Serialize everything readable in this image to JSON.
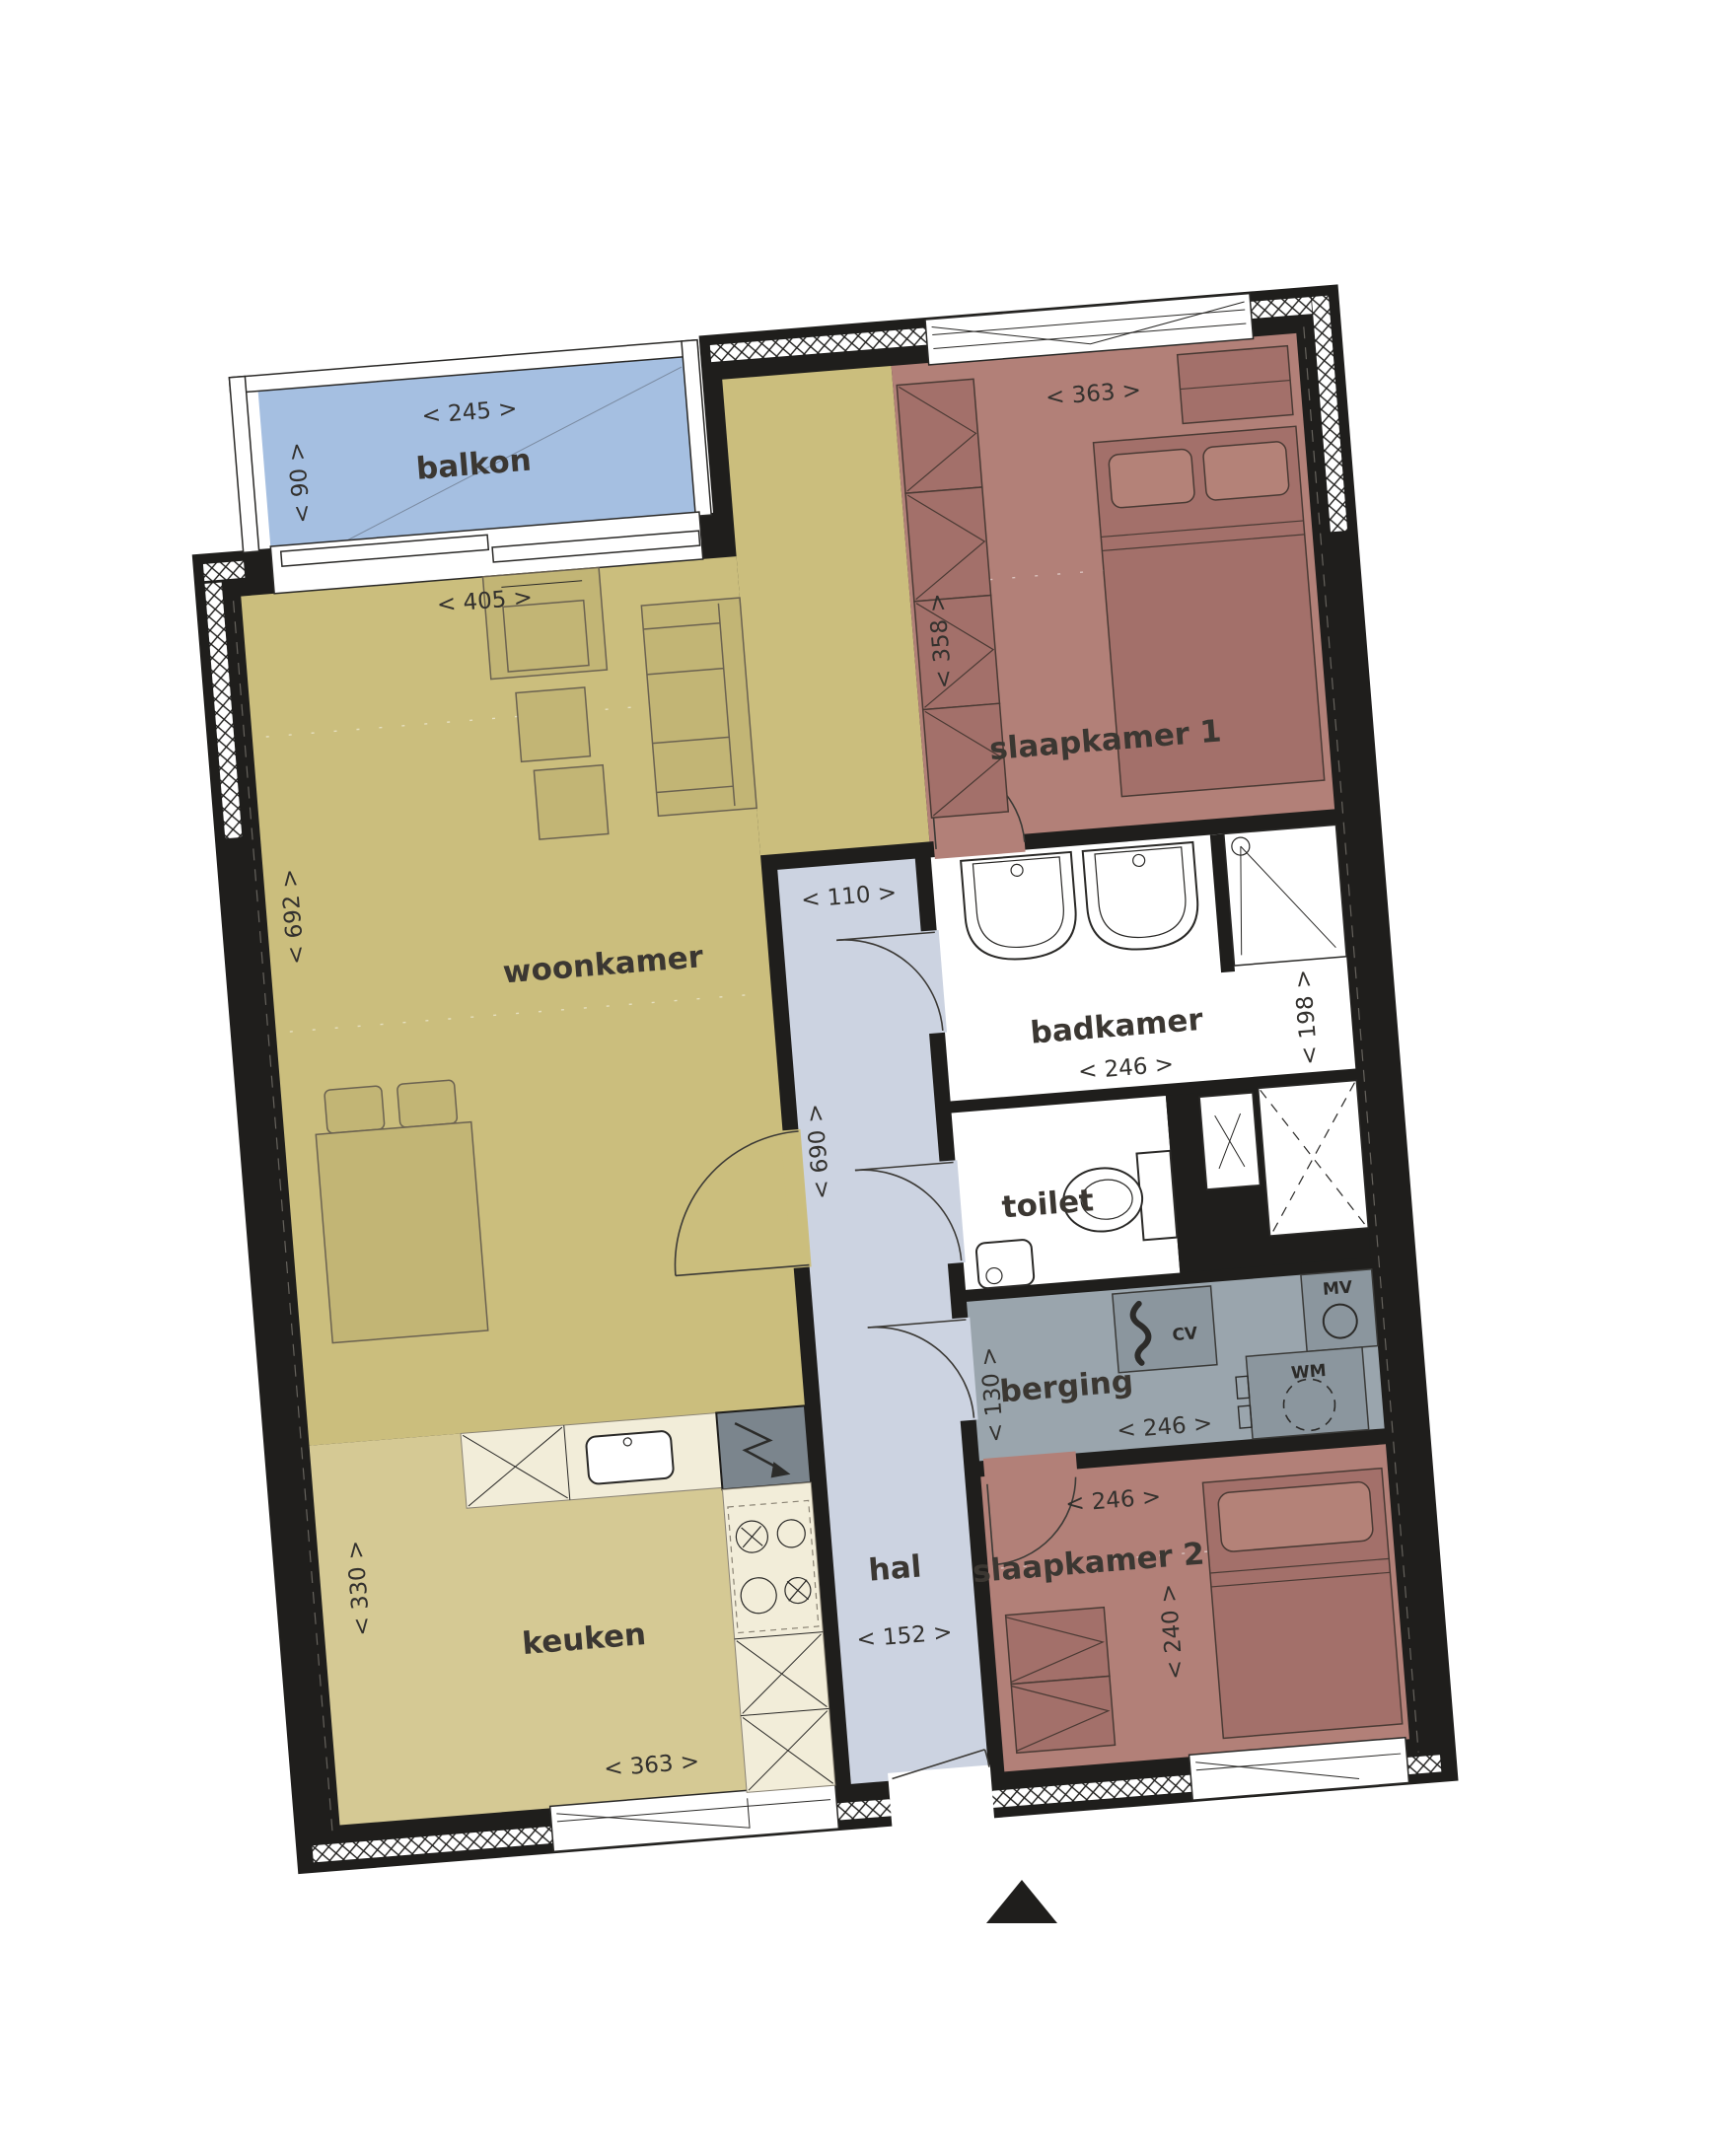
{
  "rooms": {
    "balkon": {
      "name": "balkon",
      "width": "< 245 >",
      "depth": "< 90 >"
    },
    "woonkamer": {
      "name": "woonkamer",
      "width": "< 405 >",
      "depth": "< 692 >"
    },
    "slaapkamer1": {
      "name": "slaapkamer 1",
      "width": "< 363 >",
      "depth": "< 358 >"
    },
    "badkamer": {
      "name": "badkamer",
      "width": "< 246 >",
      "depth": "< 198 >"
    },
    "toilet": {
      "name": "toilet"
    },
    "berging": {
      "name": "berging",
      "width": "< 246 >",
      "depth": "< 130 >"
    },
    "slaapkamer2": {
      "name": "slaapkamer 2",
      "width": "< 246 >",
      "depth": "< 240 >"
    },
    "hal": {
      "name": "hal",
      "width": "< 152 >",
      "width_top": "< 110 >",
      "depth": "< 690 >"
    },
    "keuken": {
      "name": "keuken",
      "width": "< 363 >",
      "depth": "< 330 >"
    }
  },
  "appliances": {
    "cv": "CV",
    "mv": "MV",
    "wm": "WM"
  },
  "colors": {
    "wall": "#1f1e1c",
    "woonkamer": "#cbbe7d",
    "keuken": "#d5c994",
    "slaapkamer": "#b28078",
    "hal": "#ccd3e1",
    "berging": "#9aa5ad",
    "balkon": "#a5bfe1",
    "counter": "#f2edd9"
  }
}
